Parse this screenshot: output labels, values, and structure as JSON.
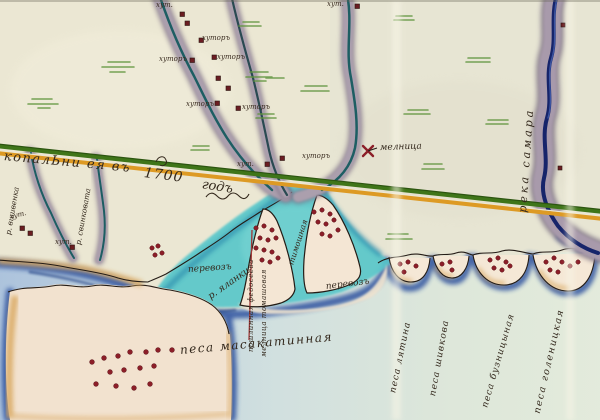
{
  "map": {
    "boundary_line": {
      "label_left": "копалЬни ея въ",
      "year": "1700",
      "year_word": "годъ"
    },
    "settlements": {
      "khutor_label": "хуторъ",
      "khutor_label_short": "хут."
    },
    "mill_label": "мелница",
    "rivers": {
      "right_river": "река самара",
      "yalanki": "р. яланки",
      "left_a": "р. вшивенка",
      "left_b": "р. свинковата"
    },
    "ferries": {
      "left": "перевозъ",
      "right": "перевозъ"
    },
    "peninsula_labels": {
      "timoshna": "тимошная",
      "col_a": "пошлинная федосеева",
      "col_b": "мелница томашовая"
    },
    "spits": {
      "masakatinnaya": "песа масакатинная",
      "lyatina": "песа лятина",
      "shivkova": "песа шивкова",
      "buznitsynaya": "песа бузницыная",
      "golenitskaya": "песа голеницкая"
    },
    "colors": {
      "paper": "#ebe7d3",
      "sea_deep": "#2b4f9e",
      "lagoon": "#56c6ca",
      "boundary_green": "#3f7519",
      "boundary_orange": "#dd9a24",
      "river_bank": "#a095a4",
      "settlement_red": "#8c1e28"
    }
  }
}
